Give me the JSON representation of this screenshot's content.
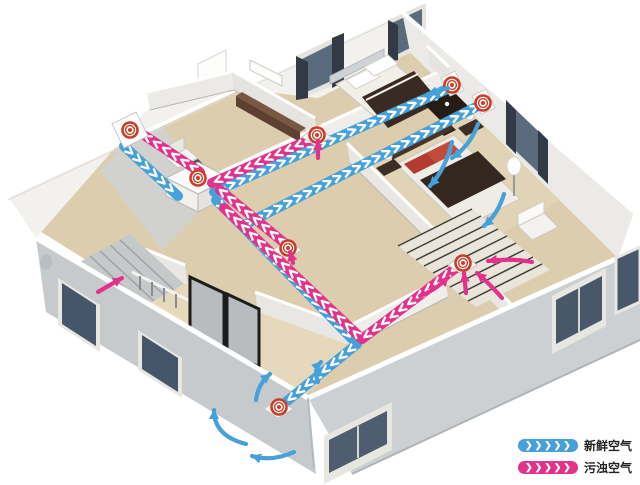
{
  "colors": {
    "fresh": "#46a0da",
    "exhaust": "#e2338c",
    "vent_ring": "#cb3d27",
    "chevron": "#ffffff"
  },
  "legend": {
    "chevrons": "❯❯❯❯❯",
    "items": [
      {
        "id": "fresh",
        "label": "新鲜空气"
      },
      {
        "id": "exhaust",
        "label": "污浊空气"
      }
    ]
  },
  "unit": {
    "id": "heat-recovery-unit",
    "x": 198,
    "y": 178
  },
  "ducts": [
    {
      "id": "outdoor-intake-duct",
      "c": "fresh",
      "pts": [
        [
          124,
          146
        ],
        [
          178,
          196
        ]
      ]
    },
    {
      "id": "outdoor-exhaust-duct",
      "c": "exhaust",
      "pts": [
        [
          200,
          172
        ],
        [
          136,
          130
        ]
      ]
    },
    {
      "id": "supply-duct-bedroom1",
      "c": "fresh",
      "pts": [
        [
          214,
          192
        ],
        [
          452,
          87
        ]
      ]
    },
    {
      "id": "supply-duct-master",
      "c": "fresh",
      "pts": [
        [
          216,
          200
        ],
        [
          242,
          226
        ],
        [
          482,
          104
        ]
      ]
    },
    {
      "id": "supply-duct-living",
      "c": "fresh",
      "pts": [
        [
          242,
          226
        ],
        [
          357,
          344
        ],
        [
          281,
          406
        ]
      ]
    },
    {
      "id": "exhaust-duct-bedroom1",
      "c": "exhaust",
      "pts": [
        [
          316,
          137
        ],
        [
          212,
          183
        ]
      ]
    },
    {
      "id": "exhaust-duct-corridor",
      "c": "exhaust",
      "pts": [
        [
          288,
          246
        ],
        [
          220,
          190
        ]
      ]
    },
    {
      "id": "exhaust-duct-master",
      "c": "exhaust",
      "pts": [
        [
          461,
          264
        ],
        [
          362,
          339
        ],
        [
          224,
          208
        ]
      ]
    }
  ],
  "vents": [
    {
      "id": "outdoor-wall-vent",
      "x": 130,
      "y": 130,
      "mount": "wall"
    },
    {
      "id": "bedroom1-exhaust-vent",
      "x": 317,
      "y": 135,
      "mount": "floor"
    },
    {
      "id": "bedroom1-supply-vent",
      "x": 452,
      "y": 85,
      "mount": "wall-small"
    },
    {
      "id": "master-supply-vent",
      "x": 483,
      "y": 103,
      "mount": "wall-small"
    },
    {
      "id": "corridor-exhaust-vent",
      "x": 288,
      "y": 248,
      "mount": "floor"
    },
    {
      "id": "master-exhaust-vent",
      "x": 463,
      "y": 263,
      "mount": "floor"
    },
    {
      "id": "living-supply-vent",
      "x": 279,
      "y": 407,
      "mount": "floor"
    }
  ],
  "flow_arrows": [
    {
      "c": "fresh",
      "d": "M452,142 Q446,168 430,186"
    },
    {
      "c": "fresh",
      "d": "M478,124 Q470,146 452,158"
    },
    {
      "c": "fresh",
      "d": "M504,194 Q498,214 484,226"
    },
    {
      "c": "fresh",
      "d": "M448,88 L428,94"
    },
    {
      "c": "fresh",
      "d": "M256,400 Q258,384 270,374"
    },
    {
      "c": "fresh",
      "d": "M318,382 Q313,370 321,362"
    },
    {
      "c": "fresh",
      "d": "M246,444 Q214,436 214,410"
    },
    {
      "c": "fresh",
      "d": "M294,452 Q272,462 252,456"
    },
    {
      "c": "exhaust",
      "d": "M318,158 L318,141"
    },
    {
      "c": "exhaust",
      "d": "M420,296 Q436,290 448,277"
    },
    {
      "c": "exhaust",
      "d": "M502,298 Q490,284 477,273"
    },
    {
      "c": "exhaust",
      "d": "M532,262 Q512,258 488,261"
    },
    {
      "c": "exhaust",
      "d": "M466,293 L464,273"
    },
    {
      "c": "exhaust",
      "d": "M98,292 L122,278"
    },
    {
      "c": "exhaust",
      "d": "M293,263 L290,252"
    }
  ]
}
